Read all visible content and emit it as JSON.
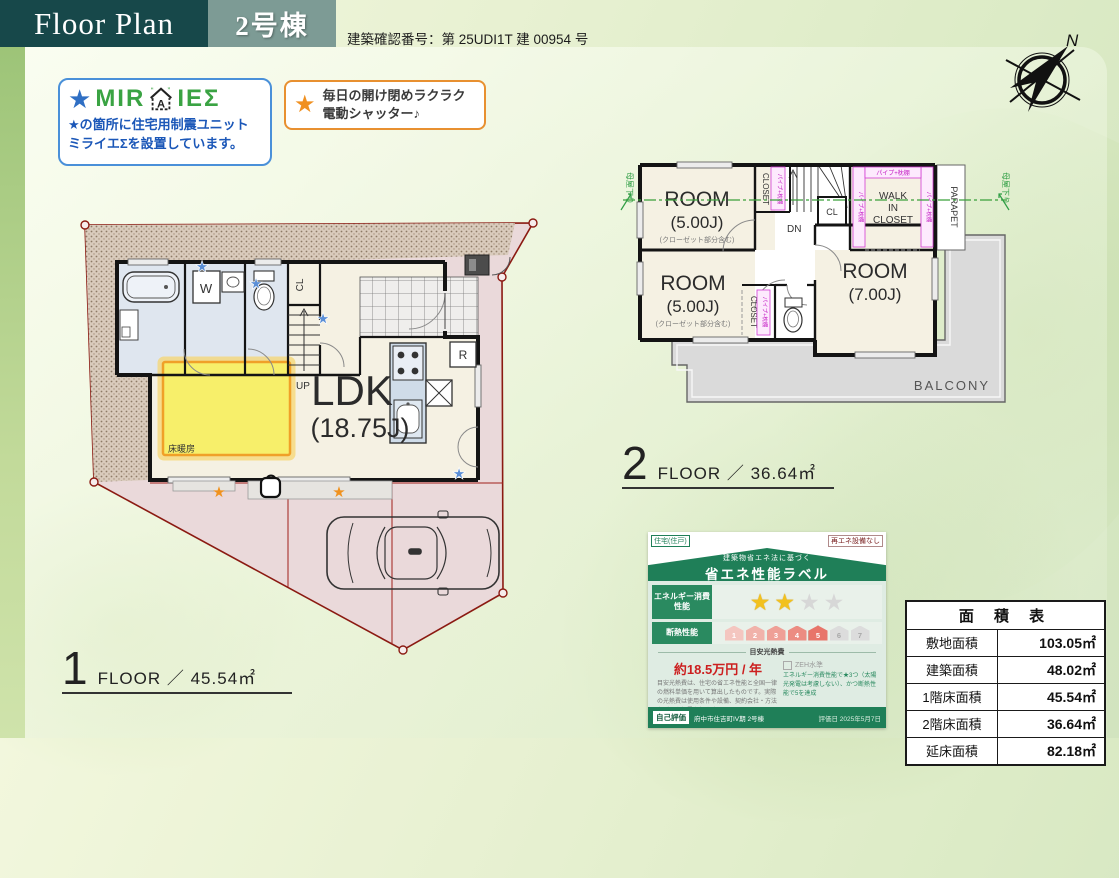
{
  "header": {
    "title": "Floor Plan",
    "building_badge": "2号棟",
    "confirmation": "建築確認番号：第 25UDI1T 建 00954 号"
  },
  "symbols": {
    "star": "★",
    "note": "♪"
  },
  "miraie_box": {
    "brand_pre": "MIR",
    "brand_a": "A",
    "brand_post": "IEΣ",
    "note_line1": "★の箇所に住宅用制震ユニット",
    "note_line2": "ミライエΣを設置しています。"
  },
  "shutter_box": {
    "line1": "毎日の開け閉めラクラク",
    "line2": "電動シャッター♪"
  },
  "compass": {
    "north": "N"
  },
  "floor1": {
    "number": "1",
    "caption": "FLOOR ／ 45.54㎡",
    "ldk": "LDK",
    "ldk_size": "(18.75J)",
    "floor_heating": "床暖房",
    "washer": "W",
    "closet": "CL",
    "stairs": "UP",
    "fridge": "R"
  },
  "floor2": {
    "number": "2",
    "caption": "FLOOR ／ 36.64㎡",
    "rooms": [
      {
        "name": "ROOM",
        "size": "(5.00J)",
        "note": "(クローゼット部分含む)"
      },
      {
        "name": "ROOM",
        "size": "(5.00J)",
        "note": "(クローゼット部分含む)"
      },
      {
        "name": "ROOM",
        "size": "(7.00J)"
      }
    ],
    "wic_line1": "WALK",
    "wic_line2": "IN",
    "wic_line3": "CLOSET",
    "closet": "CLOSET",
    "cl": "CL",
    "dn": "DN",
    "parapet": "PARAPET",
    "balcony": "BALCONY",
    "pipe_shelf": "パイプ+枕棚",
    "moya_sagari": "母屋下り"
  },
  "energy_label": {
    "top_left_badge": "住宅(住戸)",
    "top_right_note": "再エネ設備なし",
    "title_small": "建築物省エネ法に基づく",
    "title": "省エネ性能ラベル",
    "row1_label": "エネルギー消費性能",
    "row2_label": "断熱性能",
    "stars_filled": 2,
    "stars_total": 4,
    "insulation_levels": [
      "1",
      "2",
      "3",
      "4",
      "5",
      "6",
      "7"
    ],
    "insulation_achieved": 5,
    "cost_header": "目安光熱費",
    "cost_value": "約18.5万円 / 年",
    "zeh_label": "ZEH水準",
    "zeh_note": "エネルギー消費性能で★3つ（太陽光発電は考慮しない）、かつ断熱性能で5を達成",
    "disclaimer": "目安光熱費は、住宅の省エネ性能と全国一律の燃料単価を用いて算出したものです。実際の光熱費は使用条件や設備、契約会社・方法などにより異なります。",
    "self_eval_badge": "自己評価",
    "property": "府中市住吉町IV期 2号棟",
    "eval_date": "評価日 2025年5月7日"
  },
  "area_table": {
    "title": "面 積 表",
    "rows": [
      {
        "label": "敷地面積",
        "value": "103.05㎡"
      },
      {
        "label": "建築面積",
        "value": "48.02㎡"
      },
      {
        "label": "1階床面積",
        "value": "45.54㎡"
      },
      {
        "label": "2階床面積",
        "value": "36.64㎡"
      },
      {
        "label": "延床面積",
        "value": "82.18㎡"
      }
    ]
  }
}
